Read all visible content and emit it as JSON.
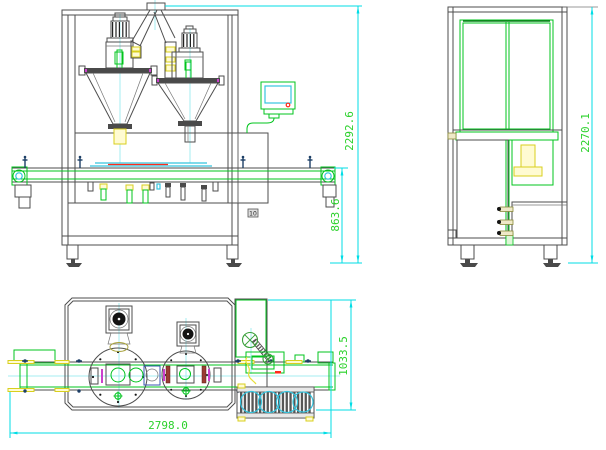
{
  "drawing": {
    "kind": "machine-assembly-cad-drawing",
    "colors": {
      "outline": "#4e4e4e",
      "green": "#00c41d",
      "dimension_line": "#00dde6",
      "dimension_text": "#2bd12b",
      "centerline": "#a5ecf2",
      "yellow": "#d8cf1e",
      "red": "#ff2a1a",
      "magenta": "#cc3fcc",
      "maroon": "#9a3c34",
      "screen_cyan": "#35c4de"
    },
    "views": {
      "front": {
        "dims": {
          "overall_height": "2292.6",
          "conveyor_height": "863.6"
        },
        "panel_tag": "10"
      },
      "side": {
        "dims": {
          "overall_height": "2270.1"
        }
      },
      "top": {
        "dims": {
          "overall_width": "2798.0",
          "overall_depth": "1033.5"
        }
      }
    }
  }
}
